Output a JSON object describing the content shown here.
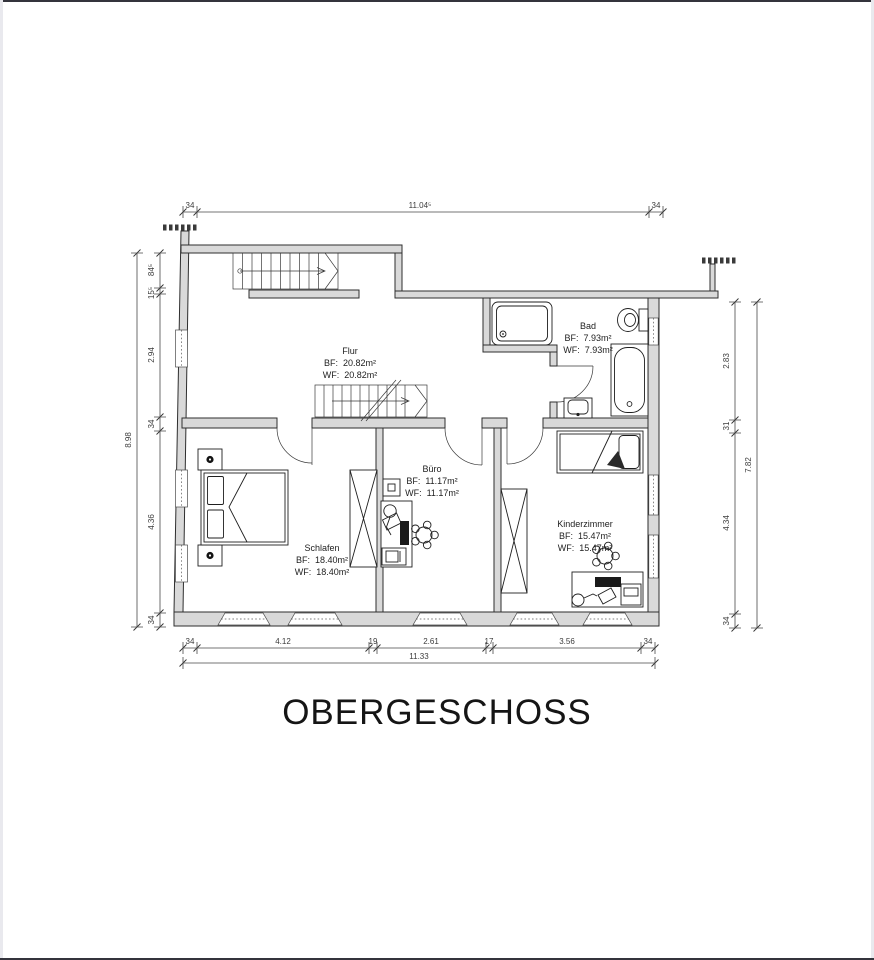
{
  "page": {
    "title": "OBERGESCHOSS"
  },
  "rooms": {
    "flur": {
      "name": "Flur",
      "bf": "BF:  20.82m²",
      "wf": "WF:  20.82m²"
    },
    "bad": {
      "name": "Bad",
      "bf": "BF:  7.93m²",
      "wf": "WF:  7.93m²"
    },
    "schlafen": {
      "name": "Schlafen",
      "bf": "BF:  18.40m²",
      "wf": "WF:  18.40m²"
    },
    "buero": {
      "name": "Büro",
      "bf": "BF:  11.17m²",
      "wf": "WF:  11.17m²"
    },
    "kinderzimmer": {
      "name": "Kinderzimmer",
      "bf": "BF:  15.47m²",
      "wf": "WF:  15.47m²"
    }
  },
  "dimensions": {
    "top": {
      "left": "34",
      "middle": "11.04⁵",
      "right": "34"
    },
    "bottom": {
      "segments": [
        "34",
        "4.12",
        "19",
        "2.61",
        "17",
        "3.56",
        "34"
      ],
      "total": "11.33"
    },
    "left": {
      "segments": [
        "84⁵",
        "15⁵",
        "2.94",
        "34",
        "4.36",
        "34"
      ],
      "total": "8.98"
    },
    "right": {
      "segments": [
        "2.83",
        "31",
        "4.34",
        "34"
      ],
      "total": "7.82"
    }
  },
  "colors": {
    "wall_fill": "#d9d9d9"
  }
}
